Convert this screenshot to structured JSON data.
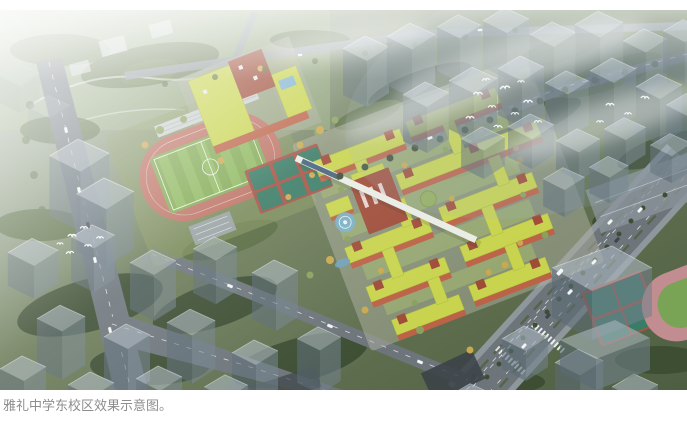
{
  "caption": {
    "text": "雅礼中学东校区效果示意图。",
    "color": "#8d8d8d"
  },
  "palette": {
    "tree-dark": "#3d4e33",
    "tree-mid": "#566a40",
    "tree-light": "#8ba05e",
    "tree-autumn": "#c9a84e",
    "road": "#6d757b",
    "sidewalk": "#9aa3a7",
    "track-red": "#bd7264",
    "field-green": "#82aa54",
    "field-green2": "#90ba60",
    "court-teal": "#3a7c66",
    "court-red": "#a65446",
    "roof-green": "#c8d44e",
    "brick": "#bc6247",
    "brick-dark": "#9e4c38",
    "ghost-top": "#a6b3bc",
    "ghost-side": "#5c6b75",
    "ghost-side2": "#72828c",
    "skylight-blue": "#7fb2cf",
    "plaza-blue": "#79b0c6",
    "haze-white": "#ffffff"
  }
}
